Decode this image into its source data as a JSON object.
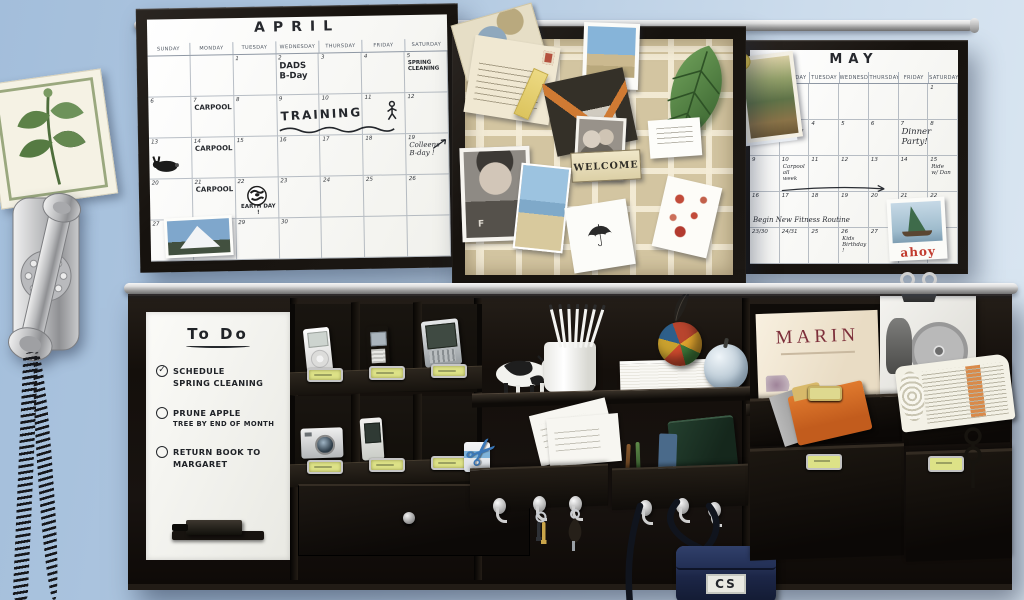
{
  "scene": {
    "description": "Family organization wall on a light blue wall: April and May dry-erase calendars, a ribbon memo pinboard, a vintage chrome wall telephone, and a black modular rail organizer with to-do board, charging cubbies, shelves, mail slots, hooks and magazine pockets",
    "wall_color": "#b7cde3",
    "frame_color": "#1a1613",
    "rail_color": "#c9c9c9",
    "pinboard_color": "#d3c5a1",
    "label_color": "#dde287"
  },
  "april": {
    "title": "APRIL",
    "weekdays": [
      "SUNDAY",
      "MONDAY",
      "TUESDAY",
      "WEDNESDAY",
      "THURSDAY",
      "FRIDAY",
      "SATURDAY"
    ],
    "weeks": [
      [
        "",
        "",
        "1",
        "2",
        "3",
        "4",
        "5"
      ],
      [
        "6",
        "7",
        "8",
        "9",
        "10",
        "11",
        "12"
      ],
      [
        "13",
        "14",
        "15",
        "16",
        "17",
        "18",
        "19"
      ],
      [
        "20",
        "21",
        "22",
        "23",
        "24",
        "25",
        "26"
      ],
      [
        "27",
        "28",
        "29",
        "30",
        "",
        "",
        ""
      ]
    ],
    "entries": [
      {
        "week": 0,
        "day": 3,
        "cls": "hand md",
        "lines": [
          "DADS",
          "B-Day"
        ]
      },
      {
        "week": 0,
        "day": 6,
        "cls": "hand xs",
        "lines": [
          "SPRING",
          "CLEANING"
        ]
      },
      {
        "week": 1,
        "day": 1,
        "cls": "hand sm",
        "lines": [
          "CARPOOL"
        ]
      },
      {
        "week": 1,
        "day": 3,
        "cls": "hand lg train",
        "span": 3,
        "lines": [
          "TRAINING"
        ]
      },
      {
        "week": 2,
        "day": 1,
        "cls": "hand sm",
        "lines": [
          "CARPOOL"
        ]
      },
      {
        "week": 2,
        "day": 6,
        "cls": "script sm",
        "lines": [
          "Colleens",
          "B-day !"
        ]
      },
      {
        "week": 3,
        "day": 1,
        "cls": "hand sm",
        "lines": [
          "CARPOOL"
        ]
      },
      {
        "week": 3,
        "day": 2,
        "cls": "hand xs lowest",
        "lines": [
          "EARTH DAY !"
        ]
      }
    ],
    "doodles": [
      {
        "type": "rabbit",
        "week": 2,
        "day": 0
      },
      {
        "type": "runner",
        "week": 1,
        "day": 5
      },
      {
        "type": "wave",
        "week": 1,
        "day": 3,
        "span": 3
      },
      {
        "type": "arrow",
        "week": 2,
        "day": 6
      },
      {
        "type": "earth",
        "week": 3,
        "day": 2
      }
    ],
    "pinned": [
      {
        "name": "pinned-mountain-postcard",
        "t": "mountain",
        "x": 14,
        "y": 198,
        "w": 68,
        "h": 40,
        "r": -2
      }
    ]
  },
  "may": {
    "title": "MAY",
    "weekdays": [
      "SUNDAY",
      "MONDAY",
      "TUESDAY",
      "WEDNESDAY",
      "THURSDAY",
      "FRIDAY",
      "SATURDAY"
    ],
    "weeks": [
      [
        "",
        "",
        "",
        "",
        "",
        "",
        "1"
      ],
      [
        "2",
        "3",
        "4",
        "5",
        "6",
        "7",
        "8"
      ],
      [
        "9",
        "10",
        "11",
        "12",
        "13",
        "14",
        "15"
      ],
      [
        "16",
        "17",
        "18",
        "19",
        "20",
        "21",
        "22"
      ],
      [
        "23/30",
        "24/31",
        "25",
        "26",
        "27",
        "28",
        "29"
      ]
    ],
    "entries": [
      {
        "week": 1,
        "day": 1,
        "cls": "script sm",
        "lines": [
          "Cindy"
        ]
      },
      {
        "week": 1,
        "day": 5,
        "cls": "script md",
        "lines": [
          "Dinner",
          "Party!"
        ]
      },
      {
        "week": 2,
        "day": 1,
        "cls": "script xs",
        "lines": [
          "Carpool",
          "all",
          "week"
        ]
      },
      {
        "week": 2,
        "day": 6,
        "cls": "script xs",
        "lines": [
          "Ride",
          "w/ Dan"
        ]
      },
      {
        "week": 3,
        "day": 0,
        "cls": "script sm low nowrap",
        "span": 4,
        "lines": [
          "Begin New Fitness Routine"
        ]
      },
      {
        "week": 4,
        "day": 3,
        "cls": "script xs",
        "lines": [
          "Kids",
          "Birthday !"
        ]
      }
    ],
    "doodles": [
      {
        "type": "arrow-long",
        "week": 2,
        "day": 1,
        "span": 4
      }
    ],
    "sailboat_text": "ahoy",
    "pinned": [
      {
        "name": "pinned-art-postcard",
        "t": "art",
        "x": -8,
        "y": 4,
        "w": 56,
        "h": 86,
        "r": -7
      },
      {
        "name": "pinned-sailboat-postcard",
        "t": "sailboat",
        "x": 138,
        "y": 148,
        "w": 58,
        "h": 62,
        "r": -3
      }
    ]
  },
  "pinboard": {
    "welcome_text": "WELCOME",
    "photo_monogram": "F",
    "items": [
      {
        "name": "pinned-map-postcard",
        "t": "map",
        "x": -8,
        "y": -26,
        "w": 84,
        "h": 58,
        "r": -16
      },
      {
        "name": "pinned-letter-card",
        "t": "letters",
        "x": 4,
        "y": 2,
        "w": 86,
        "h": 78,
        "r": 9
      },
      {
        "name": "pinned-ticket",
        "t": "ticket",
        "x": 58,
        "y": 30,
        "w": 16,
        "h": 50,
        "r": 24
      },
      {
        "name": "pinned-beach-polaroid",
        "t": "polaroid",
        "x": 118,
        "y": -16,
        "w": 56,
        "h": 66,
        "r": 2
      },
      {
        "name": "pinned-leaf",
        "t": "leaf",
        "x": 176,
        "y": 0,
        "w": 104,
        "h": 112,
        "r": 0
      },
      {
        "name": "pinned-photo-collage",
        "t": "collage",
        "x": 84,
        "y": 36,
        "w": 82,
        "h": 74,
        "r": -12
      },
      {
        "name": "pinned-family-photo",
        "t": "family",
        "x": 110,
        "y": 78,
        "w": 50,
        "h": 62,
        "r": 3
      },
      {
        "name": "pinned-business-card",
        "t": "bizcard",
        "x": 184,
        "y": 80,
        "w": 52,
        "h": 38,
        "r": -4
      },
      {
        "name": "welcome-sign",
        "t": "welcome",
        "x": 106,
        "y": 112,
        "w": 70,
        "h": 30,
        "r": -3
      },
      {
        "name": "pinned-kid-photo",
        "t": "kid",
        "x": -4,
        "y": 108,
        "w": 70,
        "h": 94,
        "r": -2
      },
      {
        "name": "pinned-beach-postcard",
        "t": "beach2",
        "x": 52,
        "y": 126,
        "w": 50,
        "h": 86,
        "r": 6
      },
      {
        "name": "pinned-umbrella-card",
        "t": "umbrella",
        "x": 104,
        "y": 164,
        "w": 62,
        "h": 66,
        "r": -9
      },
      {
        "name": "pinned-kid-art",
        "t": "kidart",
        "x": 194,
        "y": 142,
        "w": 56,
        "h": 72,
        "r": 13
      }
    ],
    "umbrella_glyph": "☂"
  },
  "todo": {
    "title": "To Do",
    "check_glyph": "✓",
    "items": [
      {
        "checked": true,
        "lines": [
          {
            "t": "SCHEDULE"
          },
          {
            "t": "SPRING CLEANING"
          }
        ]
      },
      {
        "checked": false,
        "lines": [
          {
            "t": "PRUNE APPLE"
          },
          {
            "t": "TREE BY END OF MONTH",
            "small": true
          }
        ]
      },
      {
        "checked": false,
        "lines": [
          {
            "t": "RETURN BOOK TO"
          },
          {
            "t": "MARGARET"
          }
        ]
      }
    ]
  },
  "organizer": {
    "magazine_title": "MARIN",
    "bag_monogram": "CS",
    "scissors_glyph": "✂",
    "devices": [
      "ipod",
      "flip-phone",
      "pda",
      "digital-camera",
      "slider-phone"
    ],
    "shelf_items": [
      "cow-figurine",
      "pencil-cup",
      "paper-stack",
      "woven-ball",
      "feather",
      "glass-apple"
    ],
    "mail_items": [
      "scissors",
      "envelopes",
      "pens",
      "green-notebook"
    ],
    "hooks_count": 6,
    "label_plates": 6
  }
}
